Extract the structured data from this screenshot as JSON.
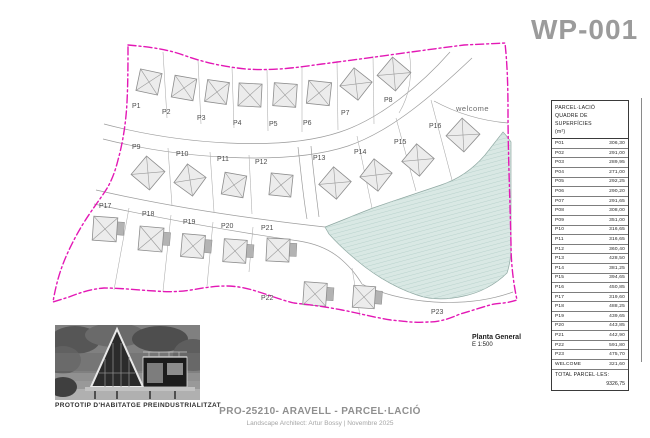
{
  "page": {
    "title": "WP-001"
  },
  "plan": {
    "welcome_label": "welcome",
    "plots": [
      "P1",
      "P2",
      "P3",
      "P4",
      "P5",
      "P6",
      "P7",
      "P8",
      "P9",
      "P10",
      "P11",
      "P12",
      "P13",
      "P14",
      "P15",
      "P16",
      "P17",
      "P18",
      "P19",
      "P20",
      "P21",
      "P22",
      "P23"
    ],
    "scale_title": "Planta General",
    "scale_value": "E 1:500"
  },
  "table": {
    "header_line1": "PARCEL·LACIÓ",
    "header_line2": "QUADRE DE SUPERFÍCIES",
    "header_line3": "(m²)",
    "rows": [
      {
        "code": "P01",
        "area": "306,30"
      },
      {
        "code": "P02",
        "area": "291,00"
      },
      {
        "code": "P03",
        "area": "289,95"
      },
      {
        "code": "P04",
        "area": "271,00"
      },
      {
        "code": "P05",
        "area": "292,25"
      },
      {
        "code": "P06",
        "area": "290,20"
      },
      {
        "code": "P07",
        "area": "291,65"
      },
      {
        "code": "P08",
        "area": "308,00"
      },
      {
        "code": "P09",
        "area": "351,00"
      },
      {
        "code": "P10",
        "area": "316,65"
      },
      {
        "code": "P11",
        "area": "316,65"
      },
      {
        "code": "P12",
        "area": "360,40"
      },
      {
        "code": "P13",
        "area": "428,50"
      },
      {
        "code": "P14",
        "area": "381,25"
      },
      {
        "code": "P15",
        "area": "394,65"
      },
      {
        "code": "P16",
        "area": "450,85"
      },
      {
        "code": "P17",
        "area": "319,60"
      },
      {
        "code": "P18",
        "area": "488,25"
      },
      {
        "code": "P19",
        "area": "439,65"
      },
      {
        "code": "P20",
        "area": "443,85"
      },
      {
        "code": "P21",
        "area": "442,90"
      },
      {
        "code": "P22",
        "area": "591,80"
      },
      {
        "code": "P23",
        "area": "475,70"
      },
      {
        "code": "WELCOME",
        "area": "321,60"
      }
    ],
    "total_label": "TOTAL PARCEL·LES:",
    "total_value": "9326,75"
  },
  "photo": {
    "caption": "PROTOTIP D'HABITATGE PREINDUSTRIALITZAT"
  },
  "footer": {
    "title": "PRO-25210- ARAVELL - PARCEL·LACIÓ",
    "subtitle": "Landscape Architect: Artur Bossy | Novembre 2025"
  },
  "colors": {
    "boundary_magenta": "#e318b5",
    "green_zone": "#d9e8e4",
    "sheet_code_gray": "#9b9b9b"
  }
}
